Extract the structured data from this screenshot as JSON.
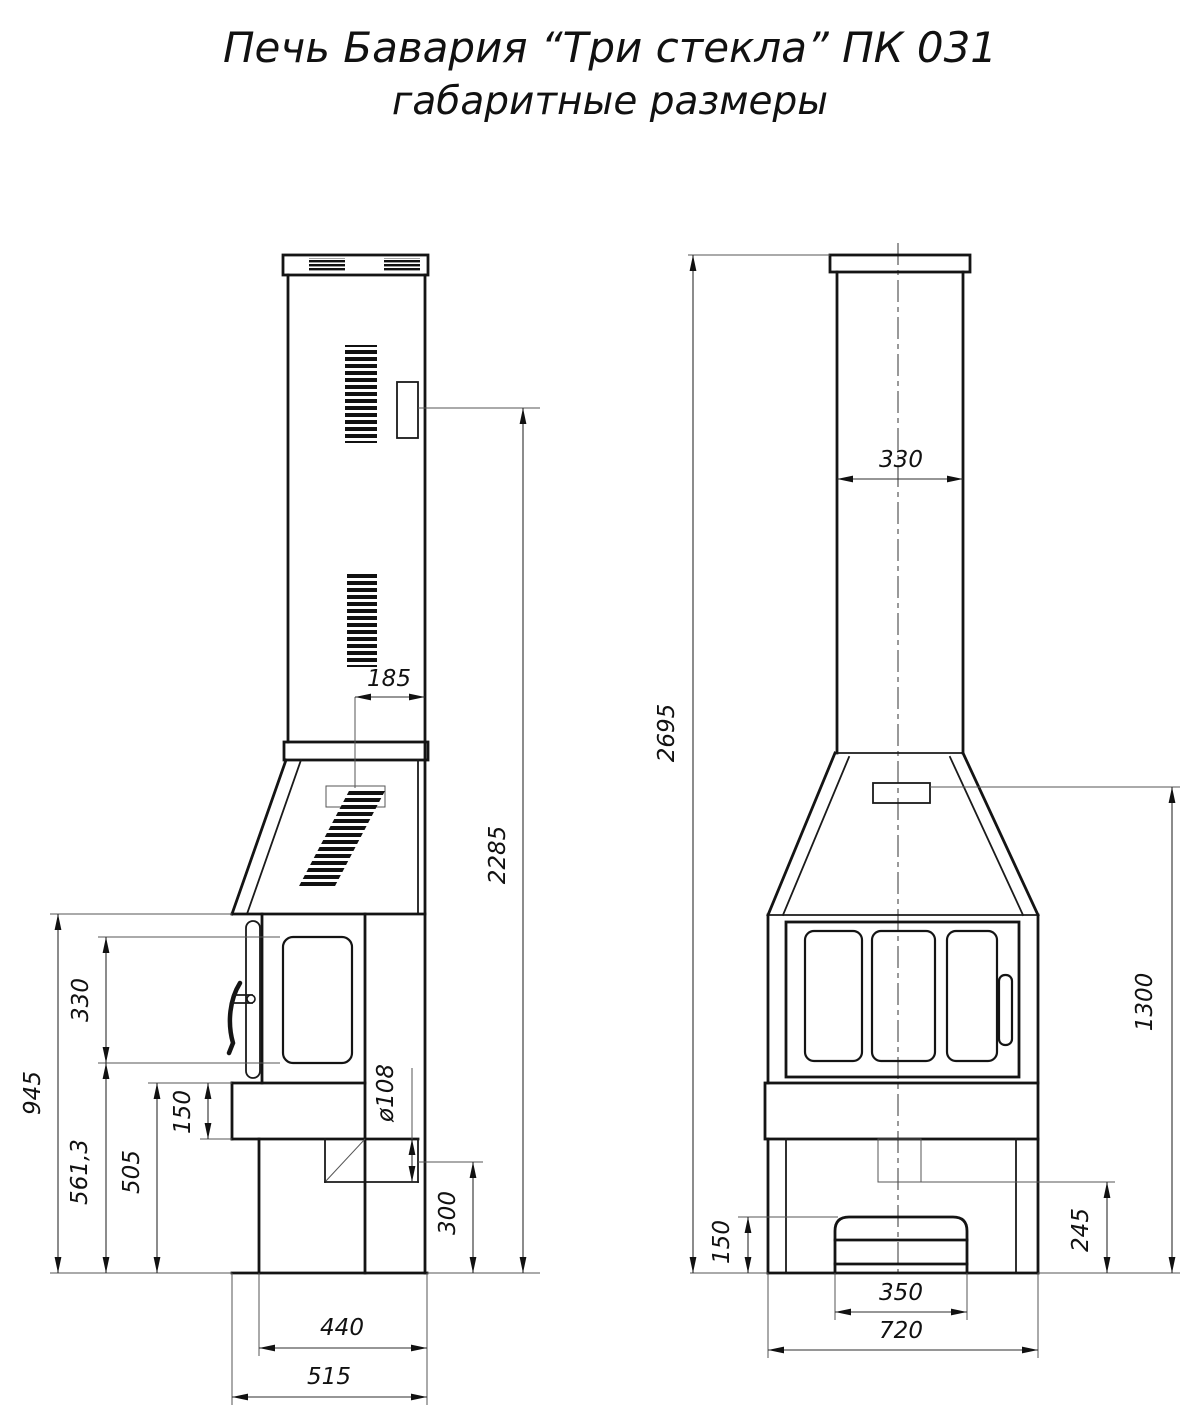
{
  "title": {
    "line1": "Печь Бавария “Три стекла” ПК 031",
    "line2": "габаритные размеры"
  },
  "colors": {
    "line": "#141414",
    "dimension": "#2e2e2e",
    "background": "#ffffff"
  },
  "side_view": {
    "dims": {
      "vent_offset": "185",
      "damper_height": "2285",
      "firebox_top_height": "945",
      "door_glass_height": "330",
      "door_bottom_height": "561,3",
      "shelf_top_height": "505",
      "shelf_band_height": "150",
      "outlet_diameter": "ø108",
      "outlet_center_height": "300",
      "base_depth": "440",
      "overall_depth": "515"
    }
  },
  "front_view": {
    "dims": {
      "pipe_width": "330",
      "overall_height": "2695",
      "damper_height": "1300",
      "drawer_height": "150",
      "outlet_bottom_height": "245",
      "drawer_width": "350",
      "overall_width": "720"
    }
  }
}
